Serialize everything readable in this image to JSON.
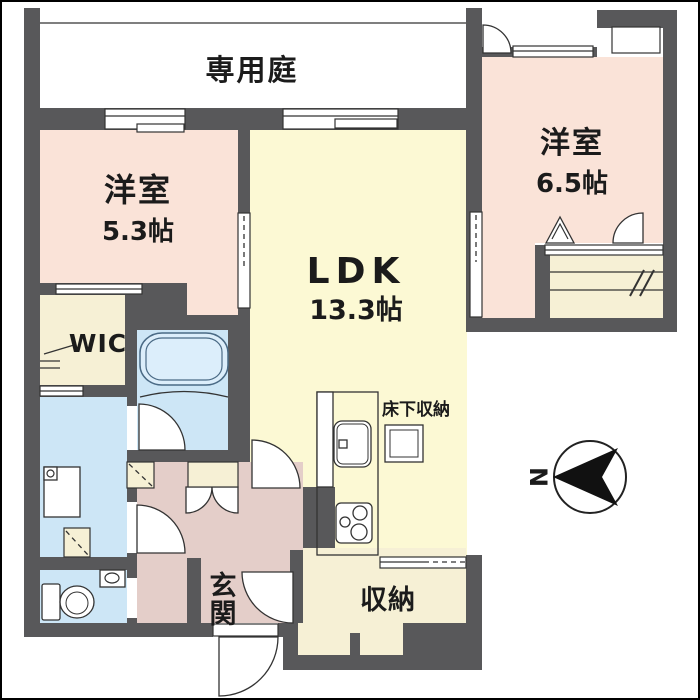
{
  "plan": {
    "garden": {
      "label": "専用庭"
    },
    "bedroom1": {
      "label": "洋室",
      "size": "5.3帖"
    },
    "bedroom2": {
      "label": "洋室",
      "size": "6.5帖"
    },
    "ldk": {
      "label": "LDK",
      "size": "13.3帖"
    },
    "wic": {
      "label": "WIC"
    },
    "underfloor_storage": {
      "label": "床下収納"
    },
    "storage": {
      "label": "収納"
    },
    "entrance": {
      "chars": [
        "玄",
        "関"
      ]
    }
  },
  "compass": {
    "label": "N"
  },
  "colors": {
    "wall": "#58585a",
    "bedroom": "#fae3d8",
    "ldk": "#fcf9d4",
    "cream": "#f6f0d5",
    "water": "#cde6f6",
    "hall": "#e4cec9",
    "tub": "#dceefb",
    "line": "#333333",
    "text": "#1b1b1b"
  }
}
